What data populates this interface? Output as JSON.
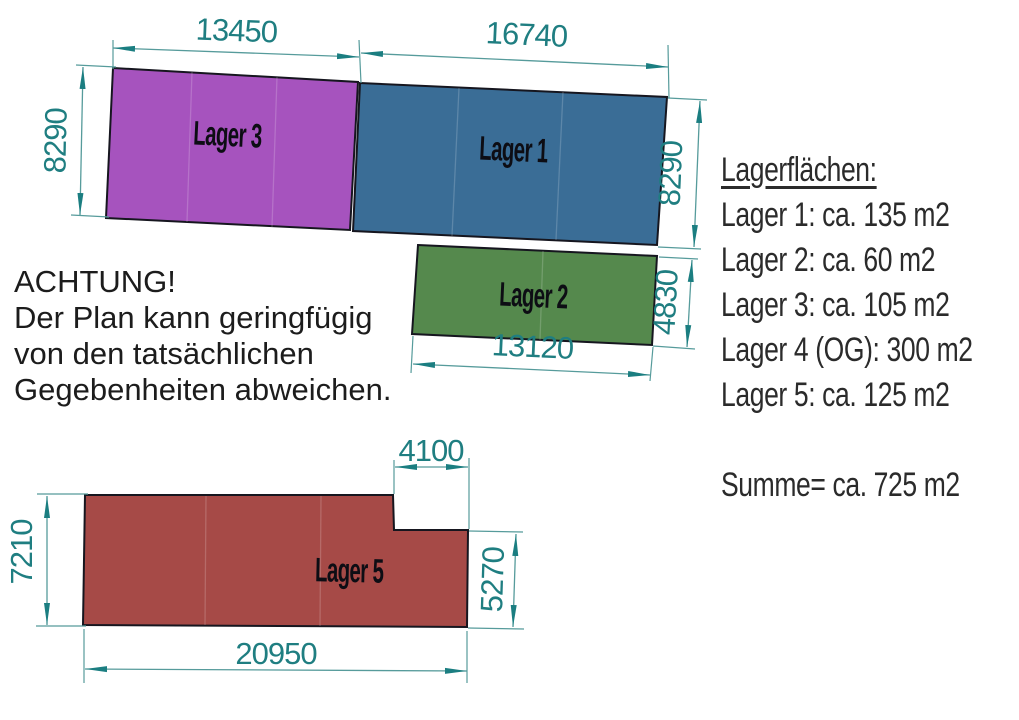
{
  "notice": {
    "line1": "ACHTUNG!",
    "line2": "Der Plan kann geringfügig",
    "line3": "von den tatsächlichen",
    "line4": "Gegebenheiten abweichen."
  },
  "legend": {
    "title": "Lagerflächen:",
    "items": [
      "Lager 1: ca. 135 m2",
      "Lager 2: ca. 60 m2",
      "Lager 3: ca. 105 m2",
      "Lager 4 (OG): 300 m2",
      "Lager 5: ca. 125 m2"
    ],
    "summary": "Summe= ca. 725 m2"
  },
  "plan": {
    "areas": [
      {
        "name": "lager-3",
        "label": "Lager 3",
        "color": "#a653be"
      },
      {
        "name": "lager-1",
        "label": "Lager 1",
        "color": "#3a6d96"
      },
      {
        "name": "lager-2",
        "label": "Lager 2",
        "color": "#55894d"
      },
      {
        "name": "lager-5",
        "label": "Lager 5",
        "color": "#a64a47"
      }
    ],
    "dims": {
      "lager3_width": "13450",
      "lager1_width": "16740",
      "lager3_height": "8290",
      "lager1_height": "8290",
      "lager2_height": "4830",
      "lager2_width": "13120",
      "lager5_height_left": "7210",
      "lager5_notch_width": "4100",
      "lager5_height_right": "5270",
      "lager5_width": "20950"
    },
    "colors": {
      "dimension_text": "#1f7e81",
      "dimension_line": "#569b9b",
      "arrow": "#1b7e81",
      "outline": "#16161f"
    }
  }
}
